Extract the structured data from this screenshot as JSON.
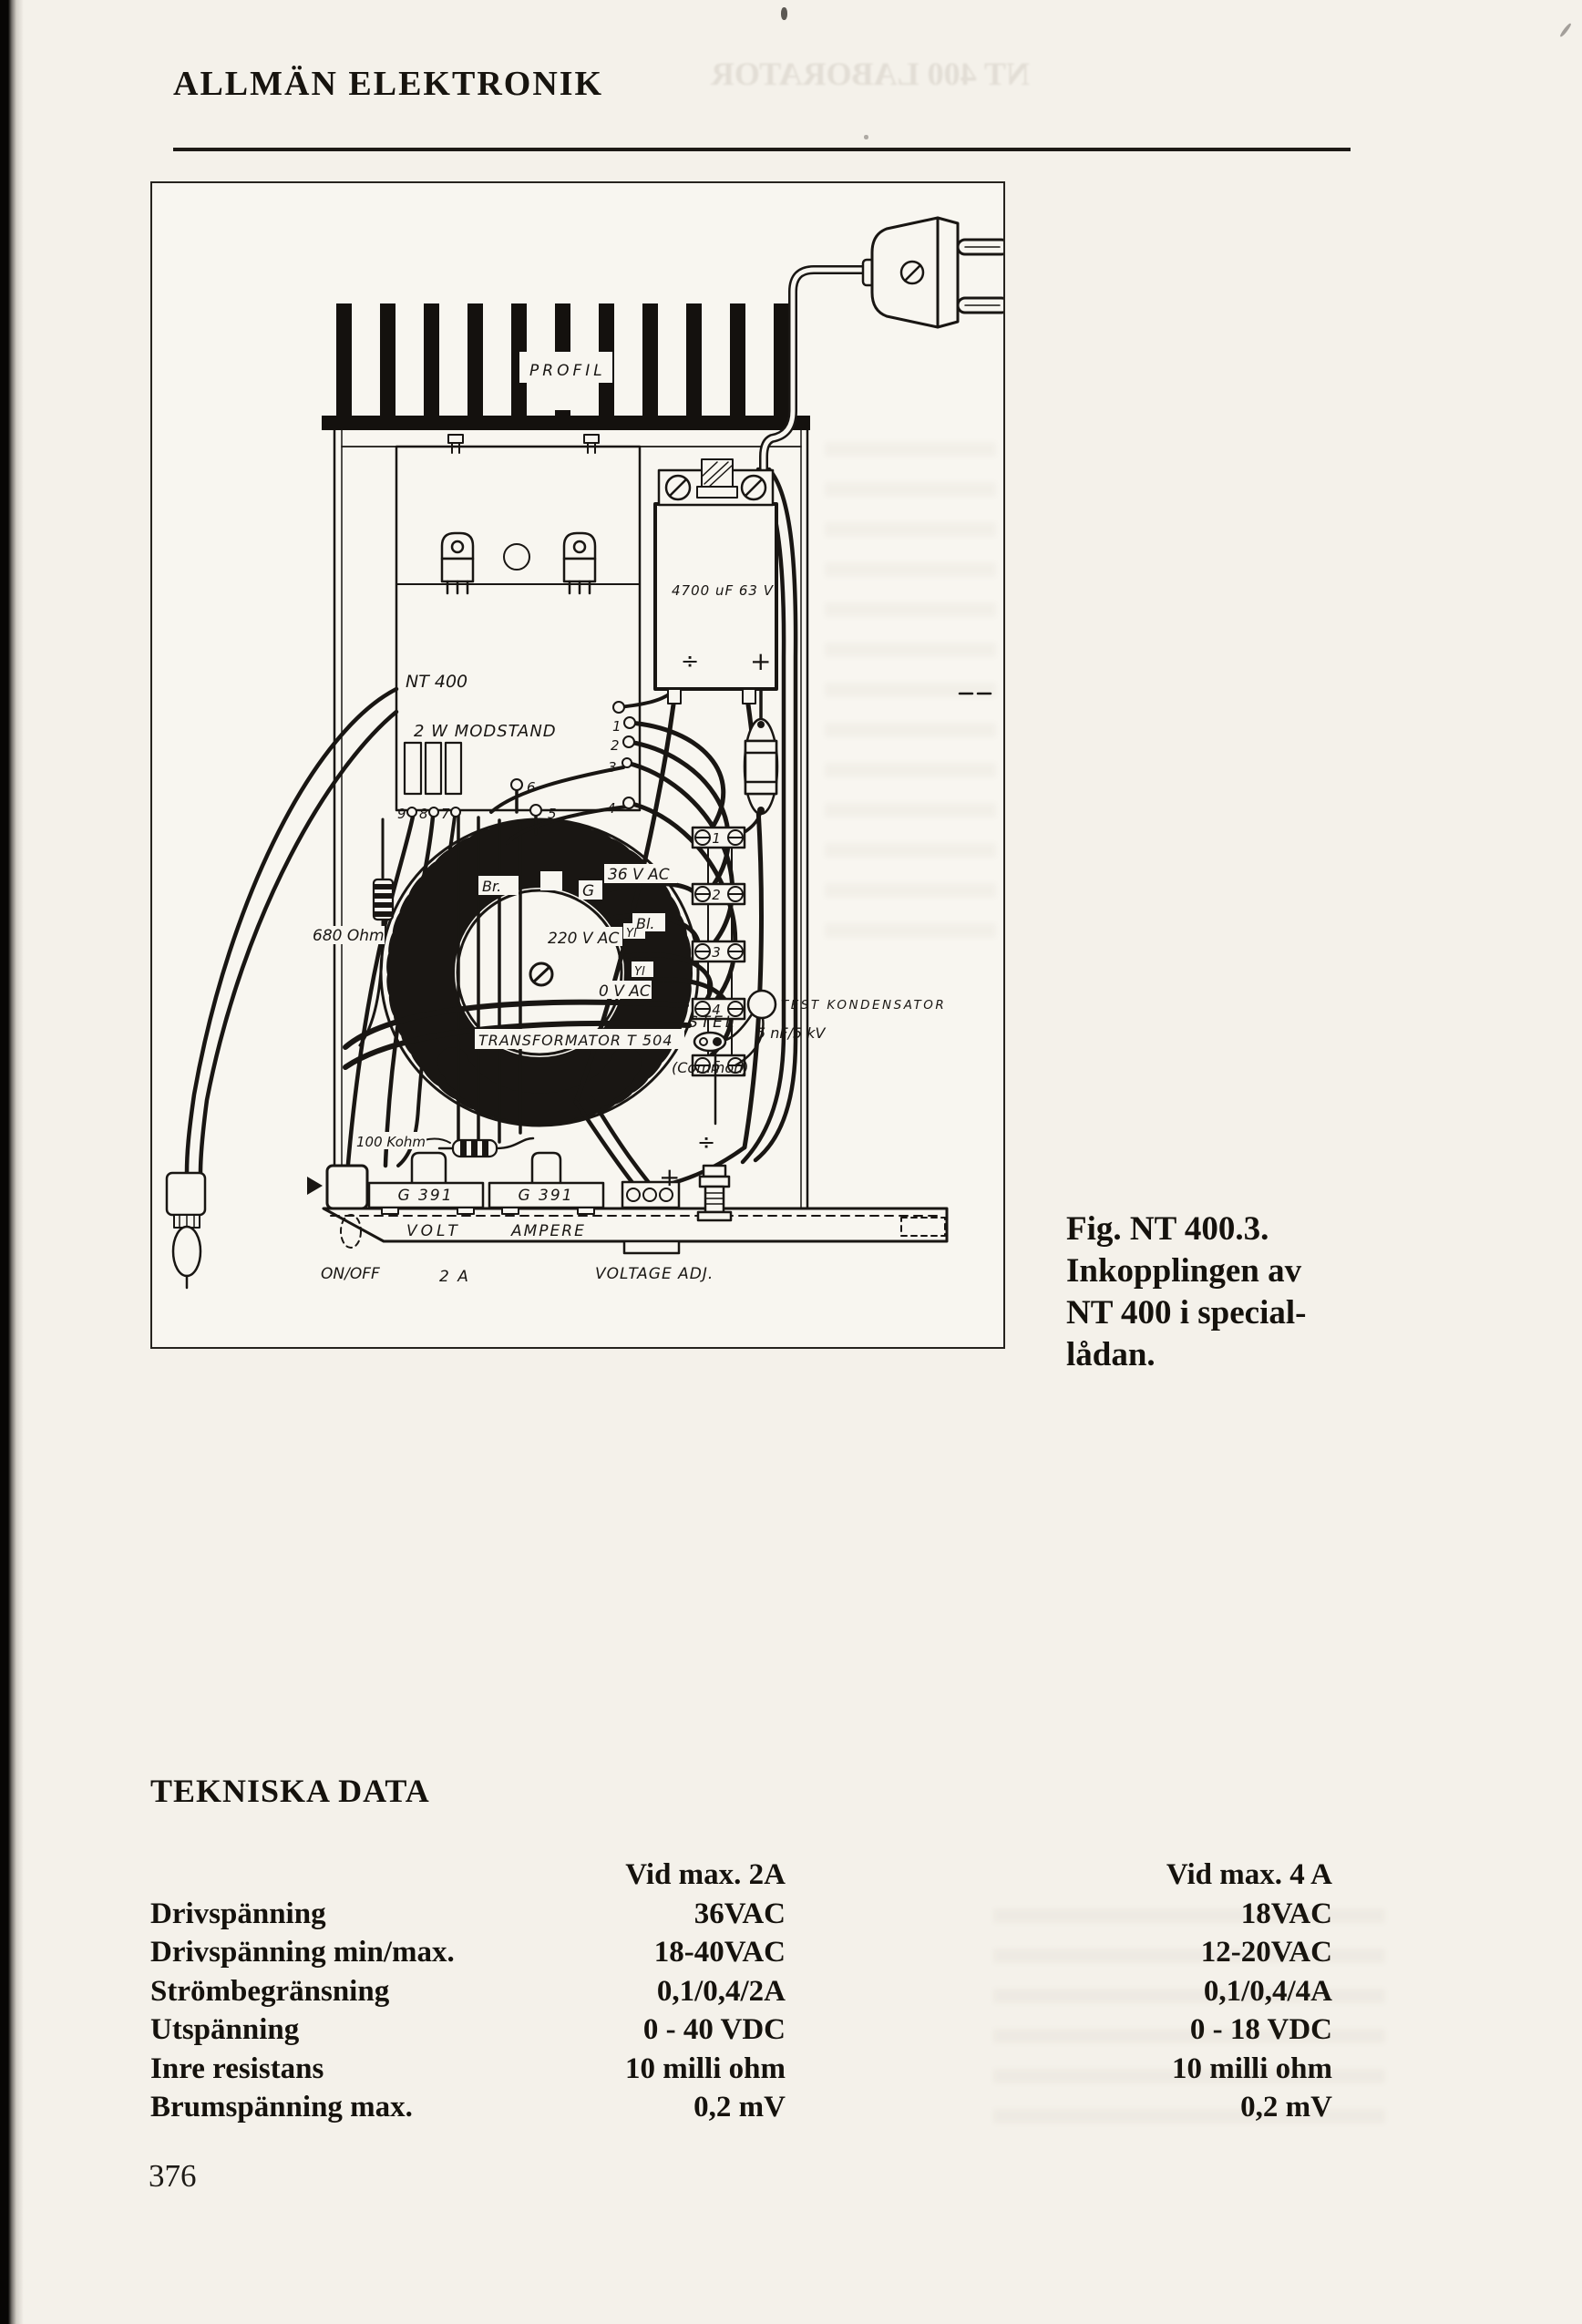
{
  "page": {
    "title": "ALLMÄN ELEKTRONIK",
    "page_number": "376"
  },
  "figure": {
    "caption": {
      "line1": "Fig. NT 400.3.",
      "line2": "Inkopplingen av",
      "line3": "NT 400 i special-",
      "line4": "lådan."
    },
    "labels": {
      "profil": "PROFIL",
      "board": "NT 400",
      "modstand": "2 W MODSTAND",
      "capacitor": "4700 uF 63 V",
      "resistor_680": "680 Ohm",
      "resistor_100k": "100 Kohm",
      "wire_brown": "Br.",
      "wire_red": "R",
      "wire_g": "G",
      "wire_blue": "Bl.",
      "wire_yellow_1": "Yl",
      "wire_yellow_2": "Yl",
      "v36": "36 V AC",
      "v220": "220 V AC",
      "v0": "0 V AC",
      "transformer": "TRANSFORMATOR T 504",
      "stel": "STEL",
      "common": "(Common)",
      "test_cap_1": "TEST KONDENSATOR",
      "test_cap_2": "5 nF/5 kV",
      "meter_volt": "G 391",
      "meter_ampere": "G 391",
      "panel_volt": "VOLT",
      "panel_ampere": "AMPERE",
      "on_off": "ON/OFF",
      "fuse_rating": "2 A",
      "voltage_adj": "VOLTAGE ADJ.",
      "minus_cap": "÷",
      "plus_cap": "+",
      "minus_post": "÷",
      "plus_post": "+"
    },
    "terminals": [
      "1",
      "2",
      "3",
      "4",
      "5"
    ],
    "board_points": {
      "left": [
        "9",
        "8",
        "7"
      ],
      "mid": [
        "6",
        "5"
      ],
      "right": [
        "1",
        "2",
        "3",
        "4"
      ]
    }
  },
  "tech_data": {
    "heading": "TEKNISKA DATA",
    "header_col1": "Vid max. 2A",
    "header_col2": "Vid max. 4 A",
    "rows": [
      {
        "label": "Drivspänning",
        "col1": "36VAC",
        "col2": "18VAC"
      },
      {
        "label": "Drivspänning min/max.",
        "col1": "18-40VAC",
        "col2": "12-20VAC"
      },
      {
        "label": "Strömbegränsning",
        "col1": "0,1/0,4/2A",
        "col2": "0,1/0,4/4A"
      },
      {
        "label": "Utspänning",
        "col1": "0 - 40 VDC",
        "col2": "0 - 18 VDC"
      },
      {
        "label": "Inre resistans",
        "col1": "10 milli ohm",
        "col2": "10 milli ohm"
      },
      {
        "label": "Brumspänning max.",
        "col1": "0,2 mV",
        "col2": "0,2 mV"
      }
    ]
  },
  "artifacts": {
    "bleed_top": "NT 400 LABORATOR"
  }
}
